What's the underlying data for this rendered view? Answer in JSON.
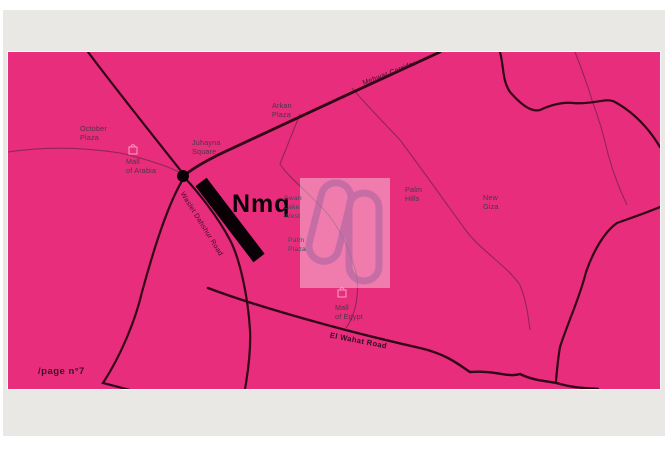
{
  "frame": {
    "page_number": "/page n°7"
  },
  "map": {
    "marker": {
      "label": "Nmq"
    },
    "places": {
      "october_plaza": {
        "l1": "October",
        "l2": "Plaza"
      },
      "mall_of_arabia": {
        "l1": "Mall",
        "l2": "of Arabia"
      },
      "juhayna_square": {
        "l1": "Juhayna",
        "l2": "Square"
      },
      "arkan_plaza": {
        "l1": "Arkan",
        "l2": "Plaza"
      },
      "palm_hills": {
        "l1": "Palm",
        "l2": "Hills"
      },
      "new_giza": {
        "l1": "New",
        "l2": "Giza"
      },
      "mall_of_egypt": {
        "l1": "Mall",
        "l2": "of Egypt"
      },
      "swan_lake_west": {
        "l1": "Swan",
        "l2": "Lake",
        "l3": "West"
      },
      "palm_plaza": {
        "l1": "Palm",
        "l2": "Plaza"
      }
    },
    "roads": {
      "mehwar_corridor": "Mehwar Corridor",
      "waslet_dahshur": "Waslet Dahshur Road",
      "el_wahat": "El Wahat Road"
    },
    "colors": {
      "map_background": "#e72d7c",
      "road_major": "#310617",
      "road_minor": "#8a2551",
      "marker_black": "#0a0106",
      "watermark_panel_tint": "#f2a7c9",
      "watermark_glyph": "#a05fa0",
      "label_text": "#463943",
      "watermark_label_text": "#35505a",
      "backdrop_gray": "#e9e8e5"
    }
  }
}
